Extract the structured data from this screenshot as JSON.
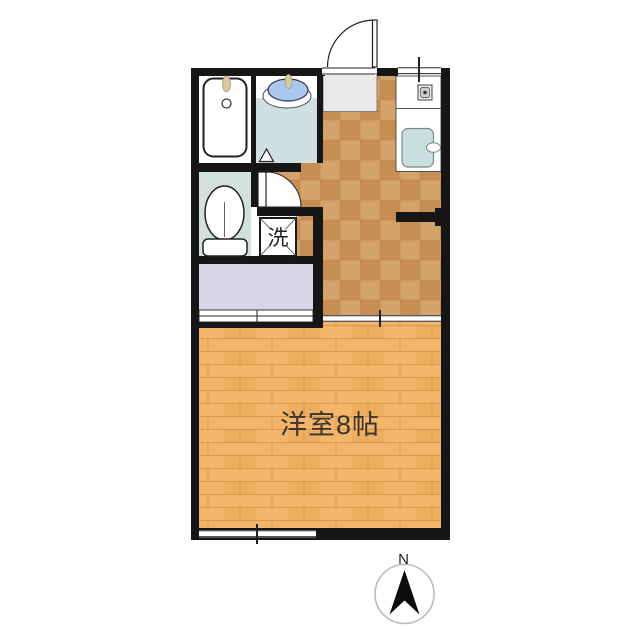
{
  "labels": {
    "main_room": "洋室8帖",
    "laundry": "洗",
    "compass_north": "N"
  },
  "colors": {
    "wall": "#161616",
    "kitchen_floor_base": "#c78e53",
    "kitchen_floor_alt": "#d4a26b",
    "kitchen_floor_line": "#b97f45",
    "room_floor_base": "#f2b56a",
    "room_floor_alt": "#eeae5f",
    "room_floor_line": "#d4964d",
    "closet_floor": "#d7d5e8",
    "toilet_floor": "#d3e1dc",
    "washroom_floor": "#cfdfe2",
    "bath_floor": "#ffffff",
    "genkan_floor": "#e9e9e9",
    "sink_blue": "#a9c9ec",
    "kitchen_sink_blue": "#c9dfdf",
    "faucet_tan": "#dcc89a",
    "compass_ring": "#bcbcbc"
  }
}
